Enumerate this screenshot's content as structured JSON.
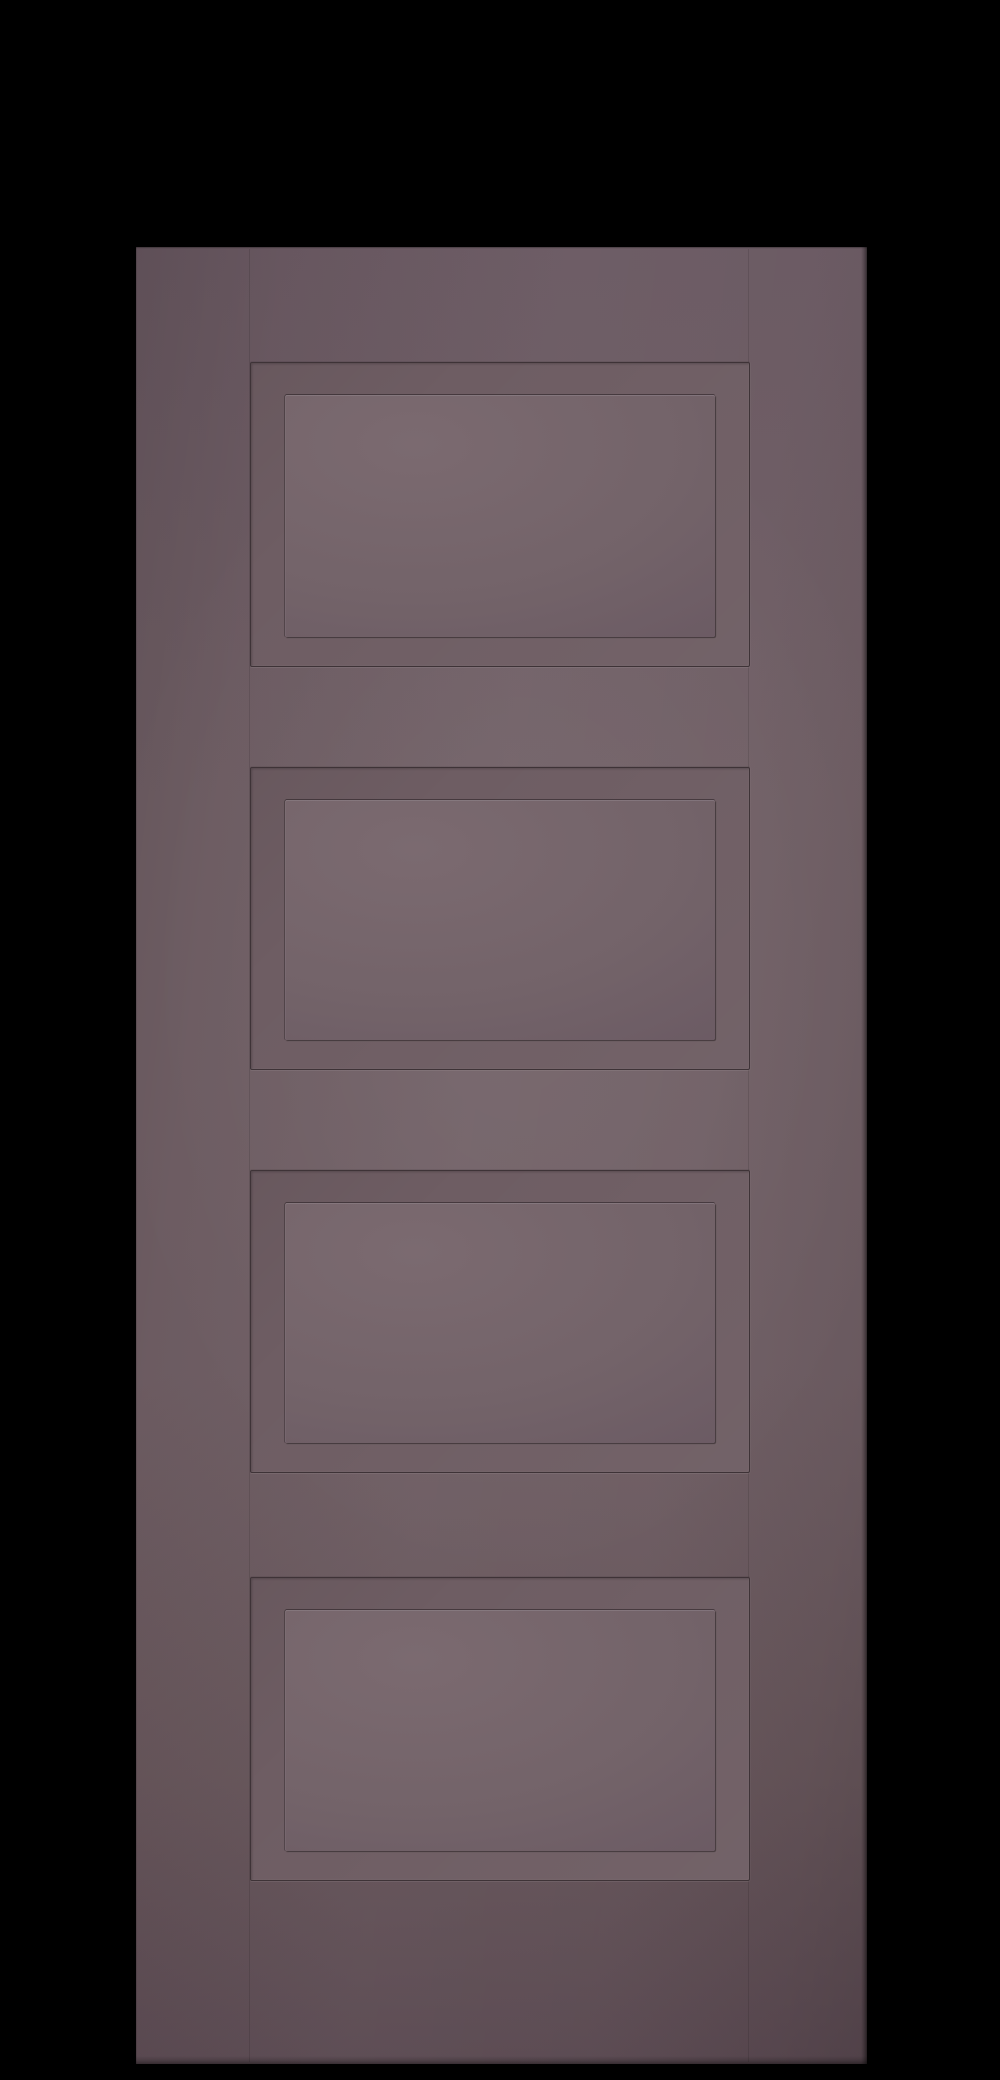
{
  "scene": {
    "description": "Render of a four-panel shaker-style interior door on a black background",
    "door": {
      "style": "four-panel shaker door",
      "panel_count": 4,
      "panels": [
        {
          "label": "panel-1"
        },
        {
          "label": "panel-2"
        },
        {
          "label": "panel-3"
        },
        {
          "label": "panel-4"
        }
      ]
    }
  },
  "theme": {
    "background": "#000000",
    "door-face": "#6e5d63",
    "door-face-top": "#695861",
    "door-face-lower": "#655459",
    "door-face-bottom": "#594850",
    "panel-field": "#736369",
    "panel-field-light": "#7b6a70",
    "panel-field-dark": "#665560",
    "groove": "#3e3337",
    "highlight": "#8a797e",
    "edge-shadow": "#241d21"
  }
}
